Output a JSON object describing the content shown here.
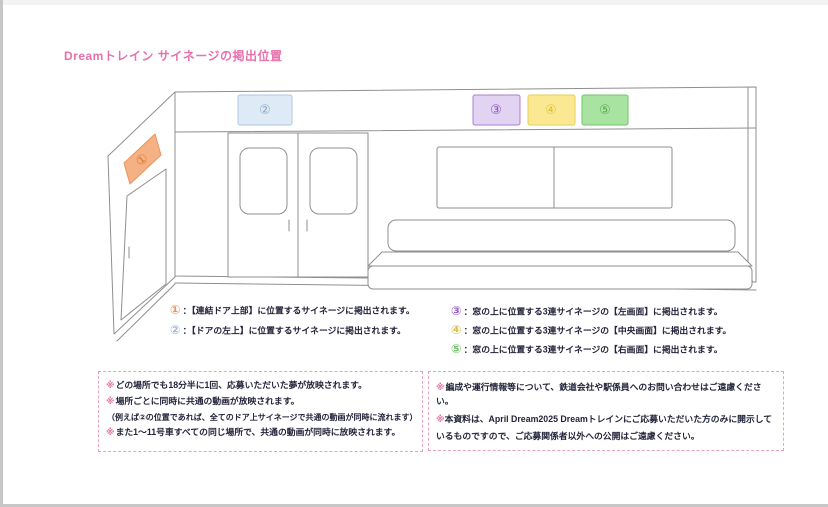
{
  "title": {
    "text": "Dreamトレイン サイネージの掲出位置",
    "color": "#E870AC"
  },
  "diagram": {
    "signs": [
      {
        "label": "①",
        "fill": "#F5B183",
        "stroke": "#E8945E",
        "label_color": "#D97A3A"
      },
      {
        "label": "②",
        "fill": "#DEEAF6",
        "stroke": "#AFC7E0",
        "label_color": "#8FA9C9"
      },
      {
        "label": "③",
        "fill": "#E3D3F2",
        "stroke": "#A97FD0",
        "label_color": "#8A4FBC"
      },
      {
        "label": "④",
        "fill": "#FBE893",
        "stroke": "#E7CE58",
        "label_color": "#DCC23B"
      },
      {
        "label": "⑤",
        "fill": "#A9E3A2",
        "stroke": "#72C66C",
        "label_color": "#57AB50"
      }
    ]
  },
  "legend": {
    "left": [
      {
        "num": "①",
        "num_color": "#E8945F",
        "text": "：【連結ドア上部】に位置するサイネージに掲出されます。"
      },
      {
        "num": "②",
        "num_color": "#A3BBD8",
        "text": "：【ドアの左上】に位置するサイネージに掲出されます。"
      }
    ],
    "right": [
      {
        "num": "③",
        "num_color": "#9B63C6",
        "text": "：窓の上に位置する3連サイネージの【左画面】に掲出されます。"
      },
      {
        "num": "④",
        "num_color": "#D9C34A",
        "text": "：窓の上に位置する3連サイネージの【中央画面】に掲出されます。"
      },
      {
        "num": "⑤",
        "num_color": "#74BE6B",
        "text": "：窓の上に位置する3連サイネージの【右画面】に掲出されます。"
      }
    ]
  },
  "notes": {
    "border_color": "#E8A2BB",
    "marker_color": "#E0759E",
    "text_color": "#23233A",
    "left": [
      {
        "marker": "※",
        "text": "どの場所でも18分半に1回、応募いただいた夢が放映されます。"
      },
      {
        "marker": "※",
        "text": "場所ごとに同時に共通の動画が放映されます。"
      },
      {
        "marker": "",
        "text": "（例えば②の位置であれば、全てのドア上サイネージで共通の動画が同時に流れます）"
      },
      {
        "marker": "※",
        "text": "また1〜11号車すべての同じ場所で、共通の動画が同時に放映されます。"
      }
    ],
    "right": [
      {
        "marker": "※",
        "text": "編成や運行情報等について、鉄道会社や駅係員へのお問い合わせはご遠慮ください。"
      },
      {
        "marker": "※",
        "text": "本資料は、April Dream2025 Dreamトレインにご応募いただいた方のみに開示しているものですので、ご応募関係者以外への公開はご遠慮ください。"
      }
    ]
  }
}
